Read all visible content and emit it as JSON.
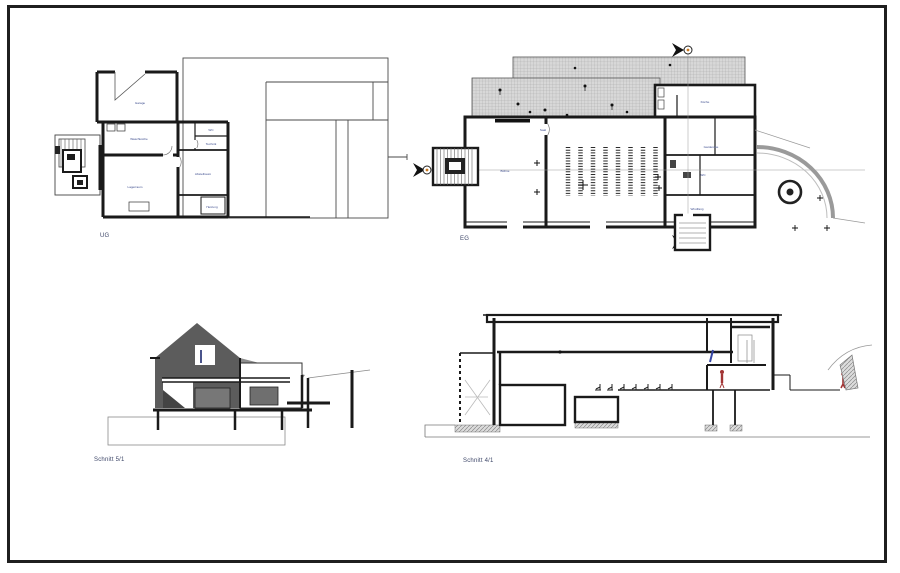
{
  "sheet": {
    "background": "#ffffff",
    "border_color": "#1f1f1f"
  },
  "colors": {
    "line": "#1a1a1a",
    "thin_line": "#777777",
    "roof_fill": "#5c5c5c",
    "roof_light": "#8d8d8d",
    "hatch_bg": "#d8d8d8",
    "hatch_line": "#a6a6a6",
    "label_blue": "#3a4a8c",
    "caption_color": "#3d4668",
    "marker_dot": "#c87820",
    "person_red": "#a23434",
    "person_blue": "#3646a5",
    "ramp_gray": "#9a9a9a"
  },
  "drawings": {
    "ug": {
      "caption": "UG",
      "rooms": {
        "garage": "Garage",
        "waschkueche": "Waschküche",
        "lagerraum": "Lagerraum",
        "abstellraum": "Abstellraum",
        "heizung": "Heizung",
        "wc": "WC",
        "technik": "Technik"
      }
    },
    "eg": {
      "caption": "EG",
      "rooms": {
        "saal": "Saal",
        "buehne": "Bühne",
        "kueche": "Küche",
        "garderobe": "Garderobe",
        "wc": "WC",
        "windfang": "Windfang"
      }
    },
    "s51": {
      "caption": "Schnitt 5/1"
    },
    "s41": {
      "caption": "Schnitt 4/1"
    }
  }
}
